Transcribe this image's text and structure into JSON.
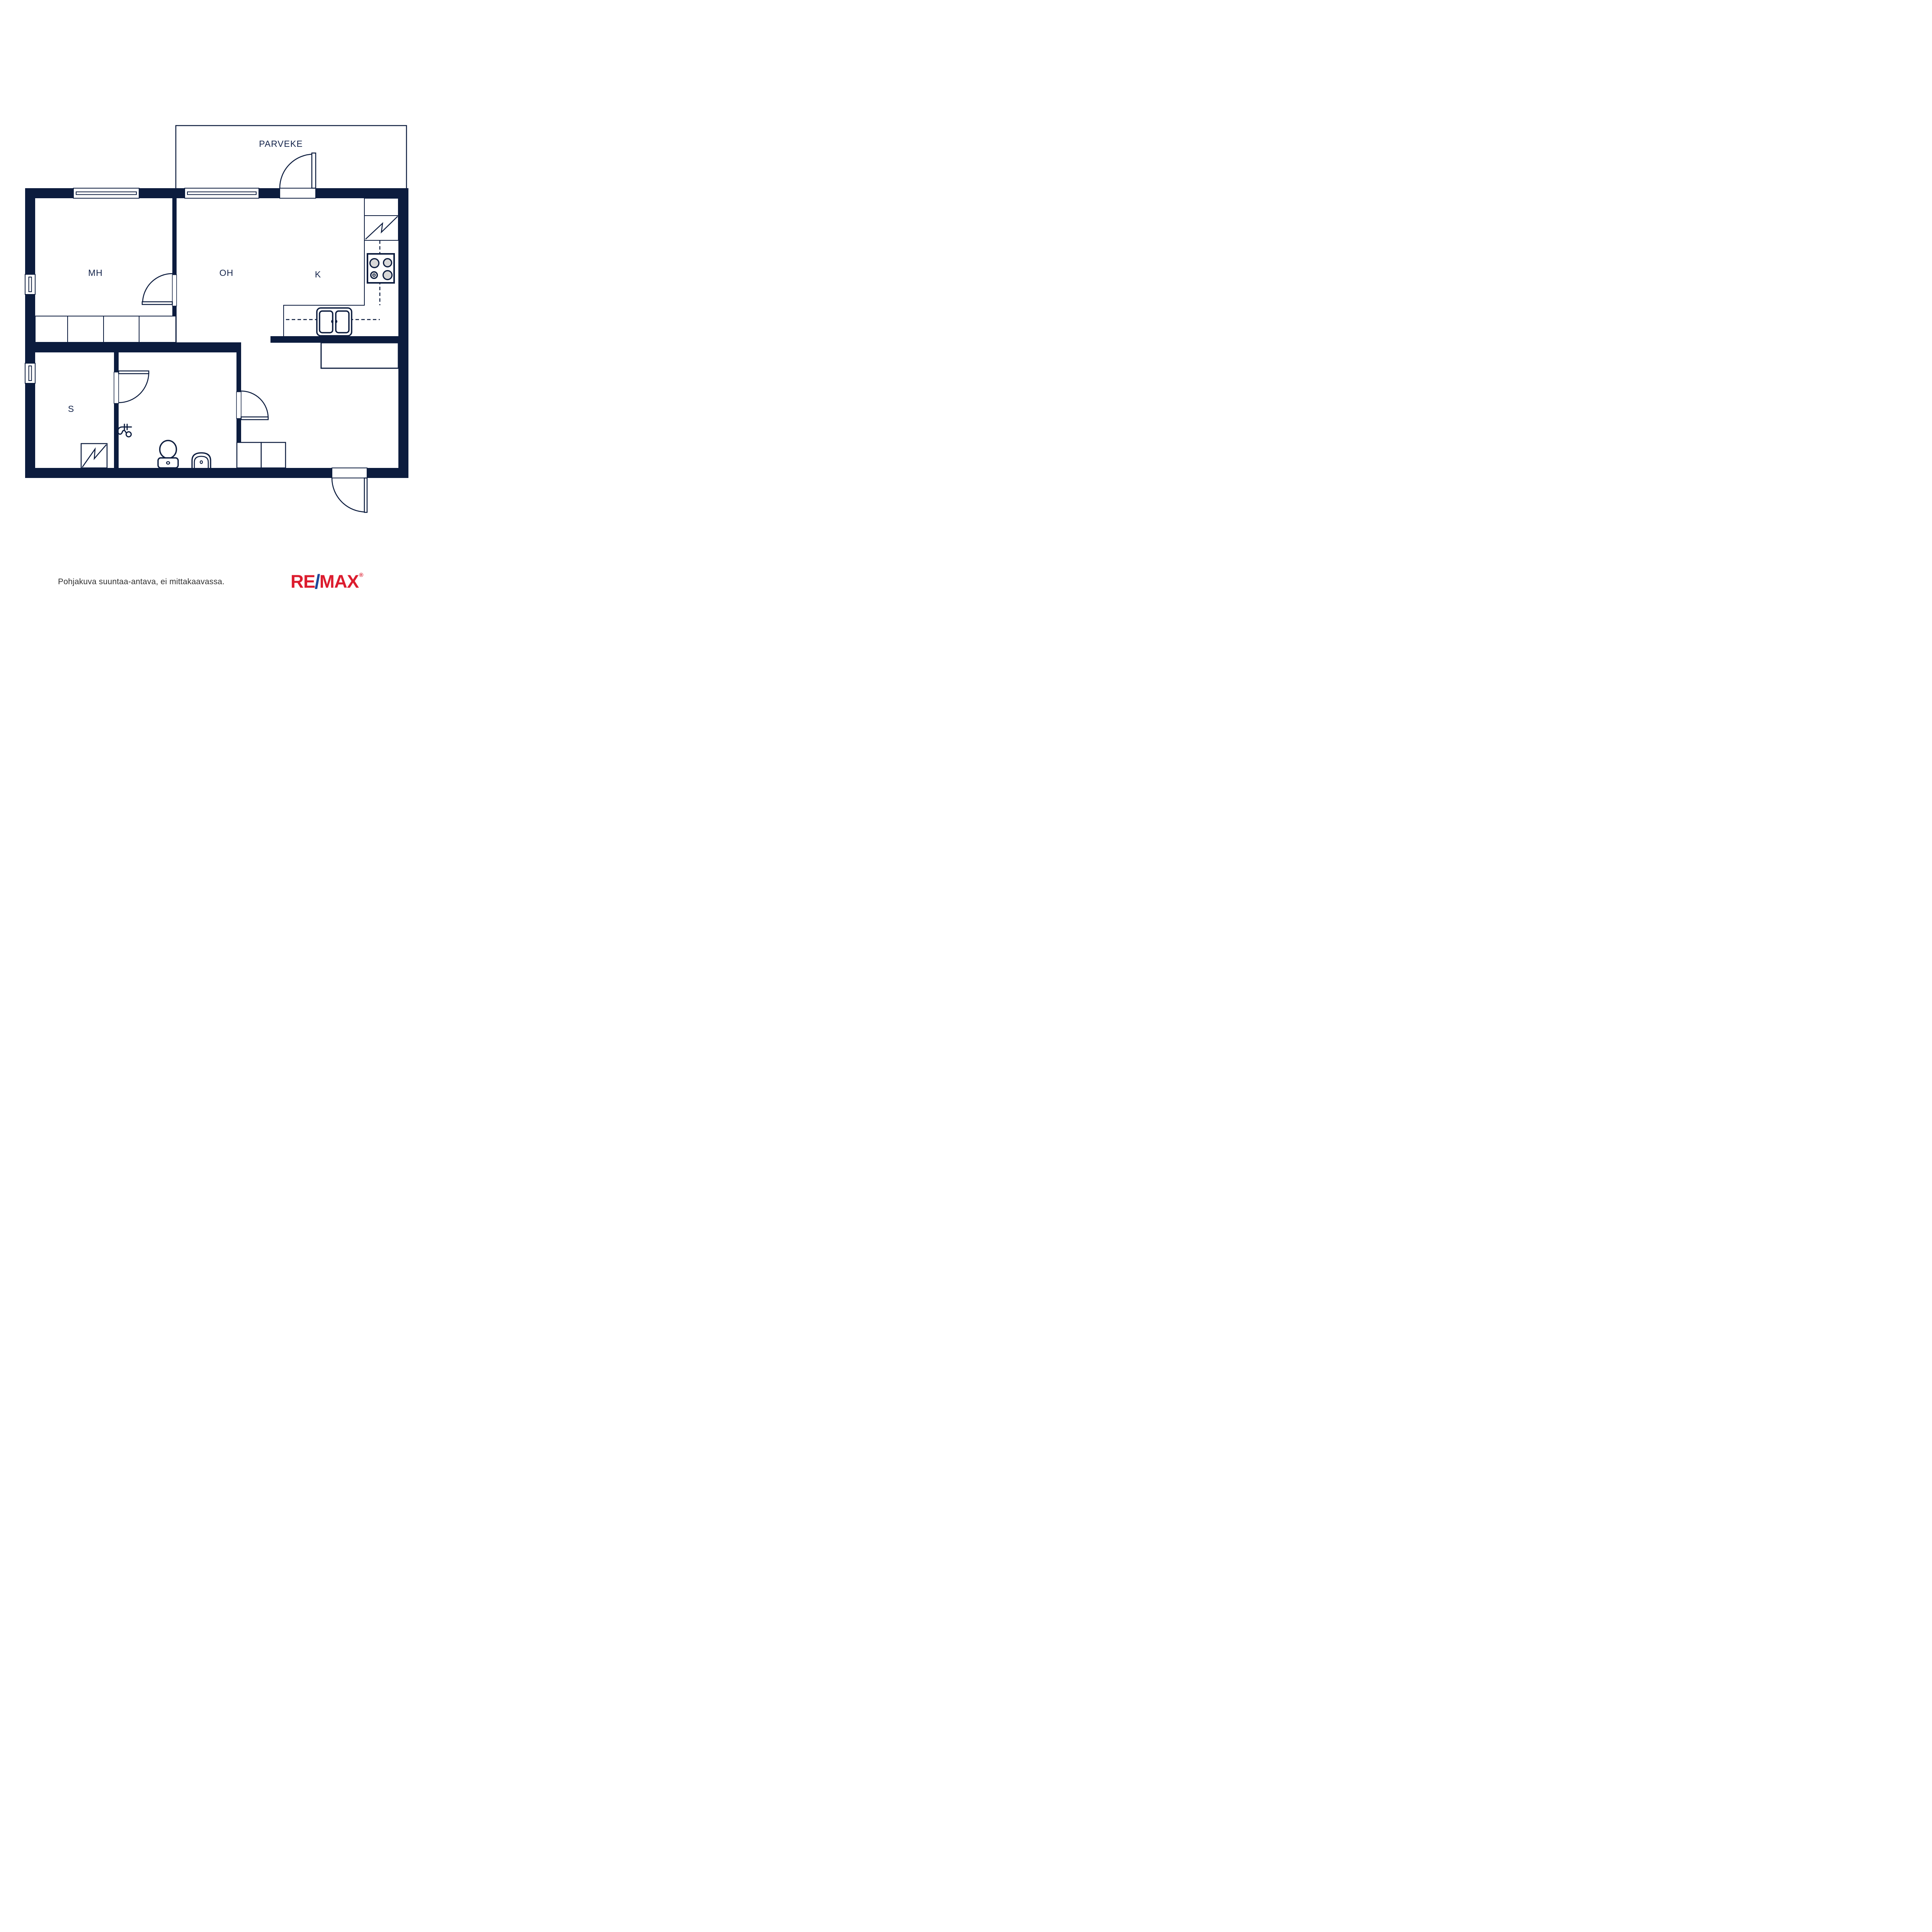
{
  "floorplan": {
    "labels": {
      "balcony": "PARVEKE",
      "bedroom": "MH",
      "living": "OH",
      "kitchen": "K",
      "sauna": "S"
    },
    "colors": {
      "wall": "#0c1c3e",
      "burner": "#d8d8d8"
    }
  },
  "footer": {
    "note": "Pohjakuva suuntaa-antava, ei mittakaavassa.",
    "logo": {
      "re": "RE",
      "slash": "/",
      "max": "MAX",
      "registered": "®"
    },
    "logo_colors": {
      "red": "#dc1c2e",
      "blue": "#1b489c"
    }
  }
}
